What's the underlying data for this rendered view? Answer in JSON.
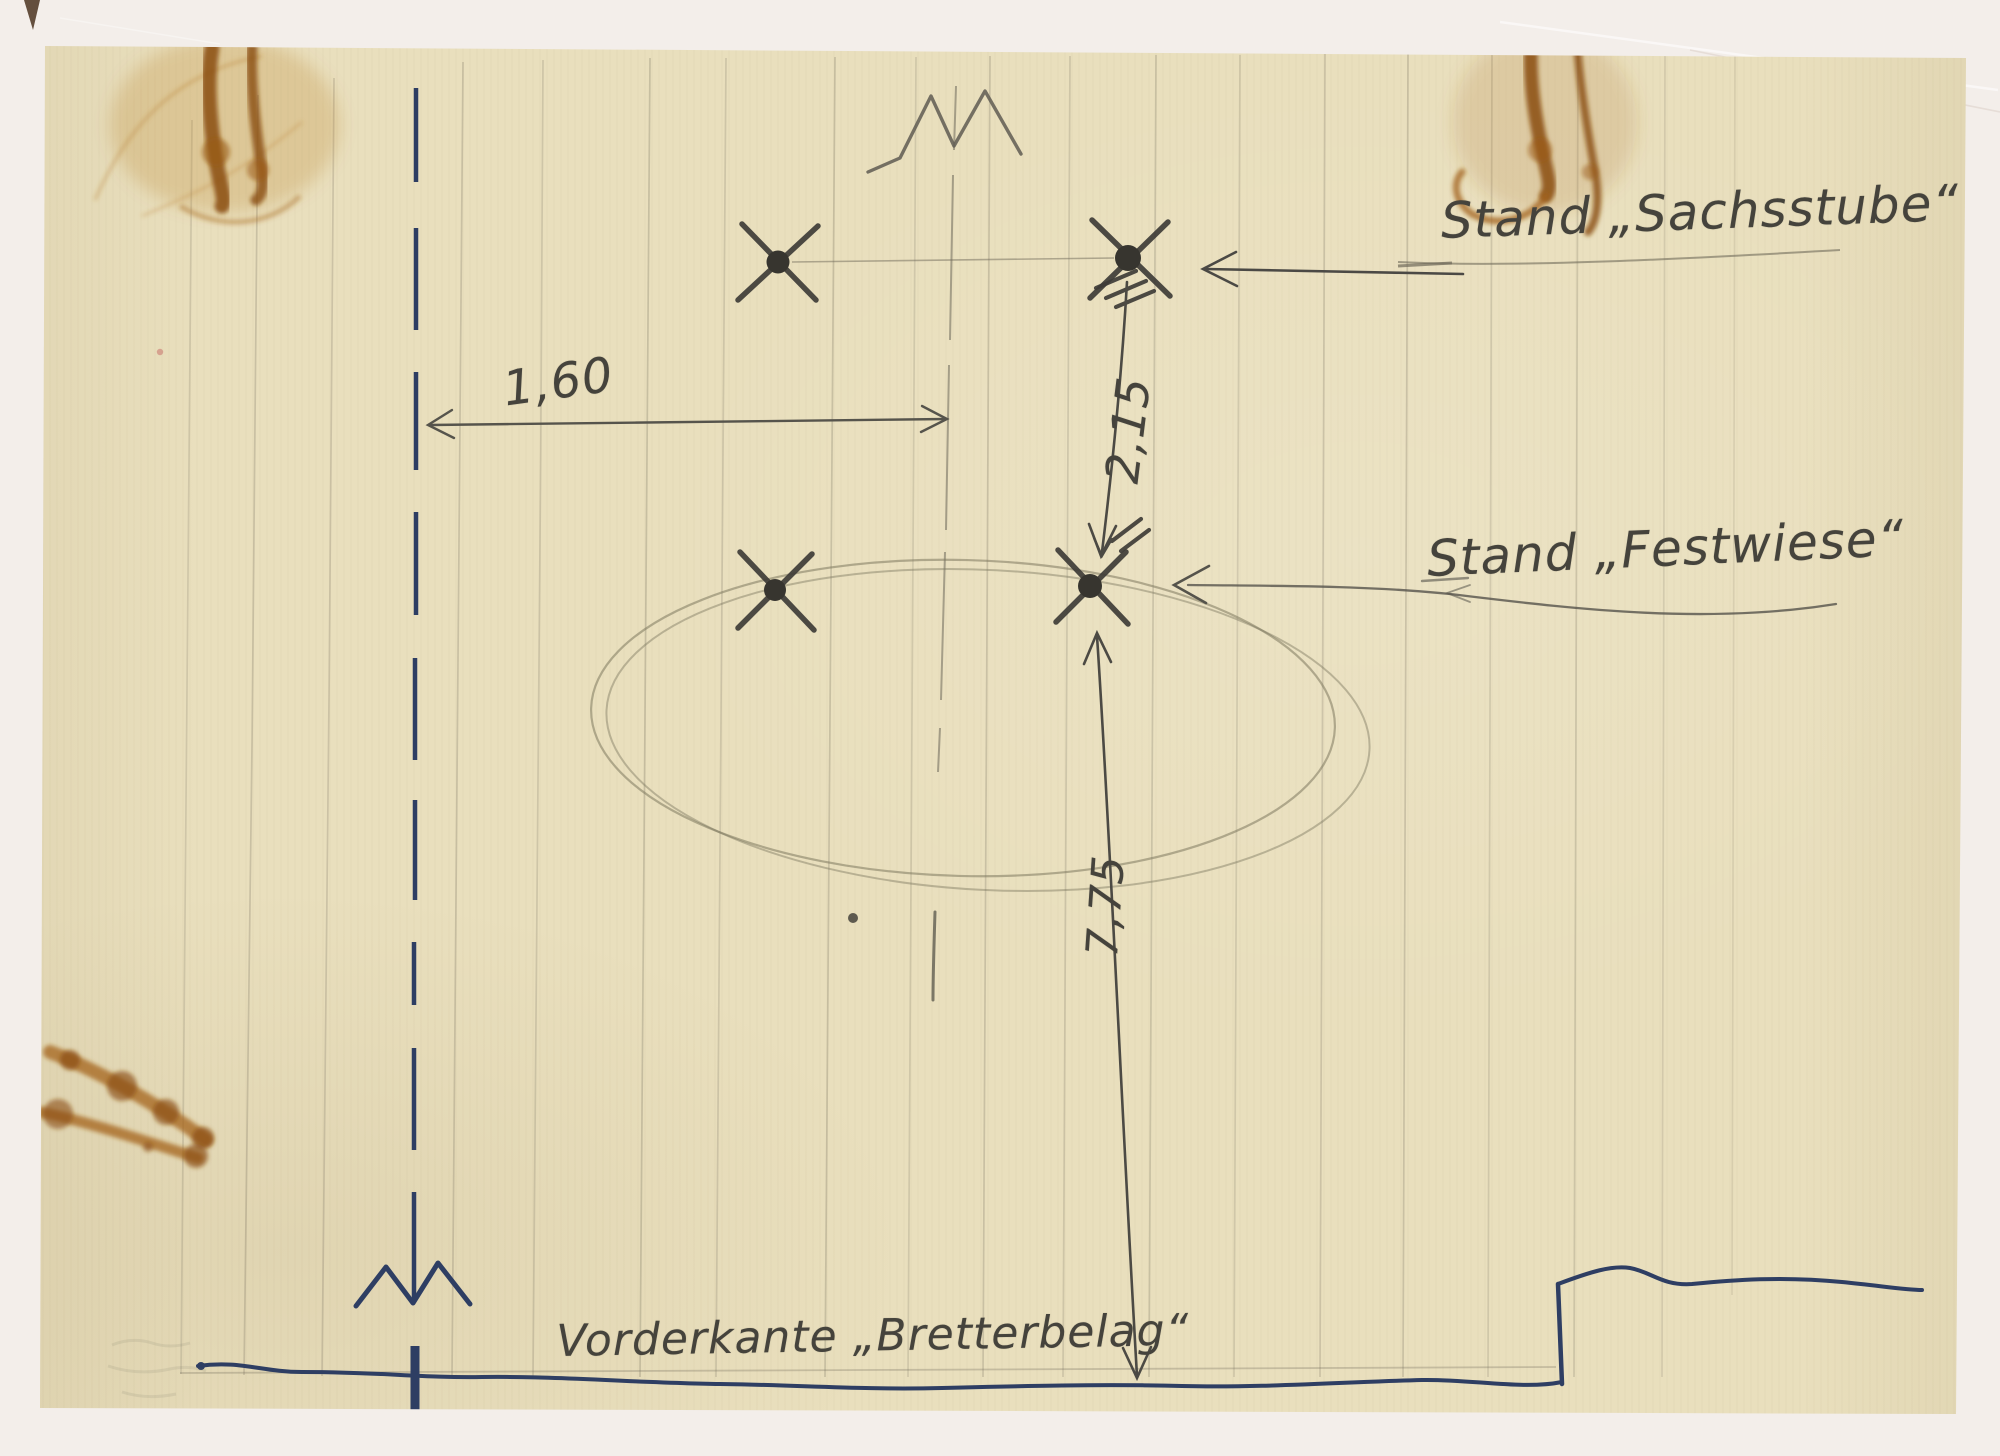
{
  "labels": {
    "stand_sachsstube": "Stand „Sachsstube“",
    "stand_festwiese": "Stand „Festwiese“",
    "vorderkante": "Vorderkante „Bretterbelag“"
  },
  "dimensions": {
    "horizontal_offset": "1,60",
    "vertical_upper": "2,15",
    "vertical_lower": "7,75"
  },
  "colors": {
    "paper": "#e9dfbd",
    "mat": "#f3eeea",
    "ink_blue": "#2e3e63",
    "pencil": "#6f6a5a",
    "graphite": "#45433c",
    "stain": "#a9681b",
    "stain_dark": "#8a4c10"
  }
}
